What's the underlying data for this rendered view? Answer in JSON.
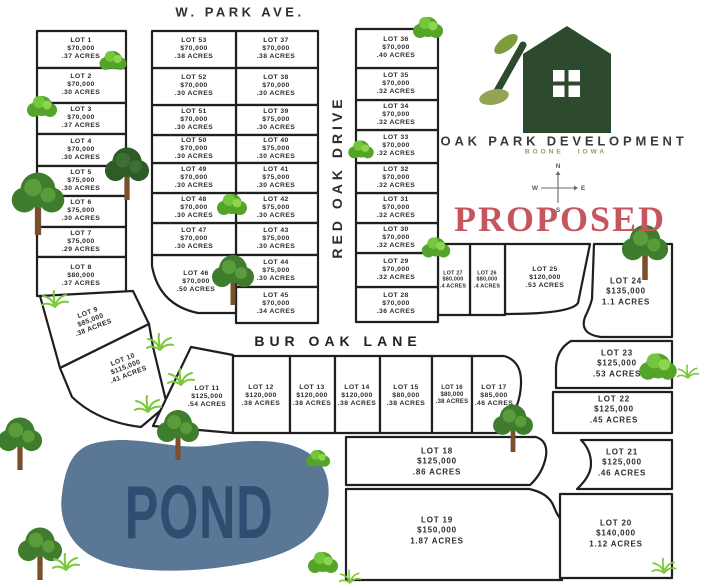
{
  "streets": {
    "top": "W. PARK AVE.",
    "vertical": "RED OAK DRIVE",
    "lane": "BUR OAK LANE"
  },
  "brand": {
    "name": "OAK PARK DEVELOPMENT",
    "city": "BOONE",
    "state": "IOWA"
  },
  "status_label": "PROPOSED",
  "pond_label": "POND",
  "compass": {
    "n": "N",
    "e": "E",
    "s": "S",
    "w": "W"
  },
  "colors": {
    "parcel_line": "#1f1f1f",
    "pond_fill": "#5a7795",
    "pond_text": "#2d4e71",
    "proposed": "#c5565e",
    "logo_green": "#2d4a2f",
    "leaf_green": "#7e9c3e",
    "brand_text": "#3a3a3a",
    "location_green": "#8d9d5e"
  },
  "lots": [
    {
      "label": "LOT 1",
      "price": "$70,000",
      "acres": ".37 ACRES"
    },
    {
      "label": "LOT 2",
      "price": "$70,000",
      "acres": ".30 ACRES"
    },
    {
      "label": "LOT 3",
      "price": "$70,000",
      "acres": ".37 ACRES"
    },
    {
      "label": "LOT 4",
      "price": "$70,000",
      "acres": ".30 ACRES"
    },
    {
      "label": "LOT 5",
      "price": "$75,000",
      "acres": ".30 ACRES"
    },
    {
      "label": "LOT 6",
      "price": "$75,000",
      "acres": ".30 ACRES"
    },
    {
      "label": "LOT 7",
      "price": "$75,000",
      "acres": ".29 ACRES"
    },
    {
      "label": "LOT 8",
      "price": "$80,000",
      "acres": ".37 ACRES"
    },
    {
      "label": "LOT 9",
      "price": "$85,000",
      "acres": ".38 ACRES"
    },
    {
      "label": "LOT 10",
      "price": "$115,000",
      "acres": ".41 ACRES"
    },
    {
      "label": "LOT 11",
      "price": "$125,000",
      "acres": ".54 ACRES"
    },
    {
      "label": "LOT 12",
      "price": "$120,000",
      "acres": ".38 ACRES"
    },
    {
      "label": "LOT 13",
      "price": "$120,000",
      "acres": ".38 ACRES"
    },
    {
      "label": "LOT 14",
      "price": "$120,000",
      "acres": ".38 ACRES"
    },
    {
      "label": "LOT 15",
      "price": "$80,000",
      "acres": ".38 ACRES"
    },
    {
      "label": "LOT 16",
      "price": "$80,000",
      "acres": ".38 ACRES"
    },
    {
      "label": "LOT 17",
      "price": "$85,000",
      "acres": ".46 ACRES"
    },
    {
      "label": "LOT 18",
      "price": "$125,000",
      "acres": ".86 ACRES"
    },
    {
      "label": "LOT 19",
      "price": "$150,000",
      "acres": "1.87 ACRES"
    },
    {
      "label": "LOT 20",
      "price": "$140,000",
      "acres": "1.12 ACRES"
    },
    {
      "label": "LOT 21",
      "price": "$125,000",
      "acres": ".46 ACRES"
    },
    {
      "label": "LOT 22",
      "price": "$125,000",
      "acres": ".45 ACRES"
    },
    {
      "label": "LOT 23",
      "price": "$125,000",
      "acres": ".53 ACRES"
    },
    {
      "label": "LOT 24",
      "price": "$135,000",
      "acres": "1.1 ACRES"
    },
    {
      "label": "LOT 25",
      "price": "$120,000",
      "acres": ".53 ACRES"
    },
    {
      "label": "LOT 26",
      "price": "$80,000",
      "acres": ".4 ACRES"
    },
    {
      "label": "LOT 27",
      "price": "$80,000",
      "acres": ".4 ACRES"
    },
    {
      "label": "LOT 28",
      "price": "$70,000",
      "acres": ".36 ACRES"
    },
    {
      "label": "LOT 29",
      "price": "$70,000",
      "acres": ".32 ACRES"
    },
    {
      "label": "LOT 30",
      "price": "$70,000",
      "acres": ".32 ACRES"
    },
    {
      "label": "LOT 31",
      "price": "$70,000",
      "acres": ".32 ACRES"
    },
    {
      "label": "LOT 32",
      "price": "$70,000",
      "acres": ".32 ACRES"
    },
    {
      "label": "LOT 33",
      "price": "$70,000",
      "acres": ".32 ACRES"
    },
    {
      "label": "LOT 34",
      "price": "$70,000",
      "acres": ".32 ACRES"
    },
    {
      "label": "LOT 35",
      "price": "$70,000",
      "acres": ".32 ACRES"
    },
    {
      "label": "LOT 36",
      "price": "$70,000",
      "acres": ".40 ACRES"
    },
    {
      "label": "LOT 37",
      "price": "$70,000",
      "acres": ".38 ACRES"
    },
    {
      "label": "LOT 38",
      "price": "$70,000",
      "acres": ".30 ACRES"
    },
    {
      "label": "LOT 39",
      "price": "$75,000",
      "acres": ".30 ACRES"
    },
    {
      "label": "LOT 40",
      "price": "$75,000",
      "acres": ".30 ACRES"
    },
    {
      "label": "LOT 41",
      "price": "$75,000",
      "acres": ".30 ACRES"
    },
    {
      "label": "LOT 42",
      "price": "$75,000",
      "acres": ".30 ACRES"
    },
    {
      "label": "LOT 43",
      "price": "$75,000",
      "acres": ".30 ACRES"
    },
    {
      "label": "LOT 44",
      "price": "$75,000",
      "acres": ".30 ACRES"
    },
    {
      "label": "LOT 45",
      "price": "$70,000",
      "acres": ".34 ACRES"
    },
    {
      "label": "LOT 46",
      "price": "$70,000",
      "acres": ".50 ACRES"
    },
    {
      "label": "LOT 47",
      "price": "$70,000",
      "acres": ".30 ACRES"
    },
    {
      "label": "LOT 48",
      "price": "$70,000",
      "acres": ".30 ACRES"
    },
    {
      "label": "LOT 49",
      "price": "$70,000",
      "acres": ".30 ACRES"
    },
    {
      "label": "LOT 50",
      "price": "$70,000",
      "acres": ".30 ACRES"
    },
    {
      "label": "LOT 51",
      "price": "$70,000",
      "acres": ".30 ACRES"
    },
    {
      "label": "LOT 52",
      "price": "$70,000",
      "acres": ".30 ACRES"
    },
    {
      "label": "LOT 53",
      "price": "$70,000",
      "acres": ".38 ACRES"
    }
  ]
}
